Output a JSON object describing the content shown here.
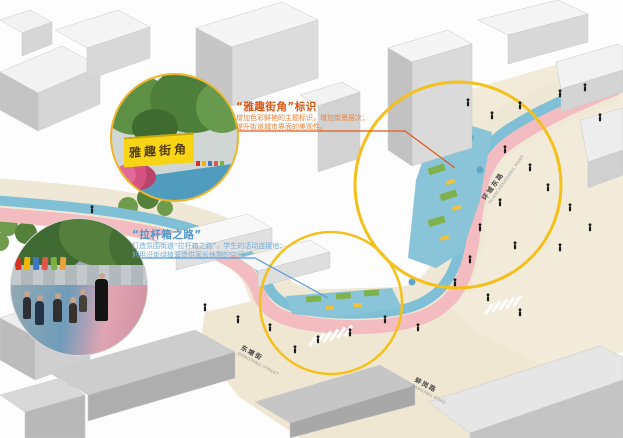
{
  "figure": {
    "annotations": {
      "street_corner": {
        "title": "“雅趣街角”标识",
        "line1": "增加色彩鲜艳的主题标识，增加街景层次；",
        "line2": "提升街道城市界面的美观性。"
      },
      "suitcase_road": {
        "title": "“拉杆箱之路”",
        "line1": "打造氛围街道“拉杆箱之路”，学生的活动连接地；",
        "line2": "利用沿街绿植营造供家长休憩的空间。"
      }
    },
    "street_labels": [
      {
        "zh": "环城东路",
        "en": "HuanChengDong Road"
      },
      {
        "zh": "东塘街",
        "en": "DongTang Street"
      },
      {
        "zh": "蚌岗路",
        "en": "BanGang Road"
      }
    ],
    "insets": {
      "corner_sign_photo": {
        "sign_text": "雅趣街角"
      },
      "walk_photo": {}
    },
    "colors": {
      "highlight_circle": "#f3c01c",
      "walkway_blue": "#7fc0d6",
      "sidewalk_pink": "#f3bcc0",
      "plaza_cream": "#f2ebd9",
      "annotation_orange": "#d85510",
      "annotation_blue": "#4f96cc"
    }
  }
}
